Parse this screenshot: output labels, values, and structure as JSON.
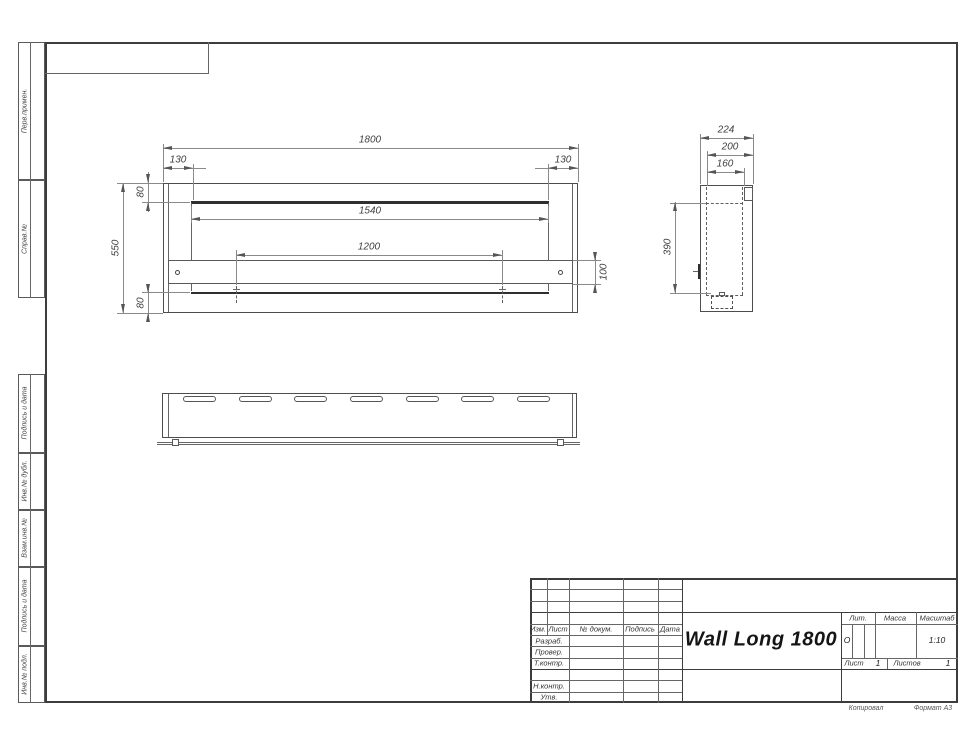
{
  "drawing_title": "Wall Long 1800",
  "left_strip": {
    "sections": [
      {
        "label": "Перв.примен."
      },
      {
        "label": "Справ.№"
      },
      {
        "label": "Подпись и дата"
      },
      {
        "label": "Инв.№ дубл."
      },
      {
        "label": "Взам.инв.№"
      },
      {
        "label": "Подпись и дата"
      },
      {
        "label": "Инв.№ подл."
      }
    ]
  },
  "views": {
    "front": {
      "dims": {
        "overall_width": "1800",
        "side_offset_left": "130",
        "side_offset_right": "130",
        "top_inset": "80",
        "overall_height": "550",
        "opening_width": "1540",
        "mount_span": "1200",
        "bracket_height": "100",
        "bottom_inset": "80"
      }
    },
    "side": {
      "dims": {
        "overall_depth": "224",
        "depth_mid": "200",
        "depth_inner": "160",
        "inner_height": "390"
      }
    },
    "bottom": {
      "slot_count": 7
    }
  },
  "title_block": {
    "header_columns": [
      "Изм.",
      "Лист",
      "№ докум.",
      "Подпись",
      "Дата"
    ],
    "row_labels": [
      "Разраб.",
      "Провер.",
      "Т.контр.",
      "Н.контр.",
      "Утв."
    ],
    "product_title": "Wall Long 1800",
    "lit": {
      "label": "Лит.",
      "value": "О"
    },
    "mass": {
      "label": "Масса",
      "value": ""
    },
    "scale": {
      "label": "Масштаб",
      "value": "1:10"
    },
    "sheet": {
      "label": "Лист",
      "value": "1"
    },
    "sheets": {
      "label": "Листов",
      "value": "1"
    }
  },
  "footer": {
    "copied_label": "Копировал",
    "format_label": "Формат А3"
  },
  "colors": {
    "line": "#555555",
    "thick_line": "#2f2f2f",
    "text": "#3f3f3f"
  }
}
